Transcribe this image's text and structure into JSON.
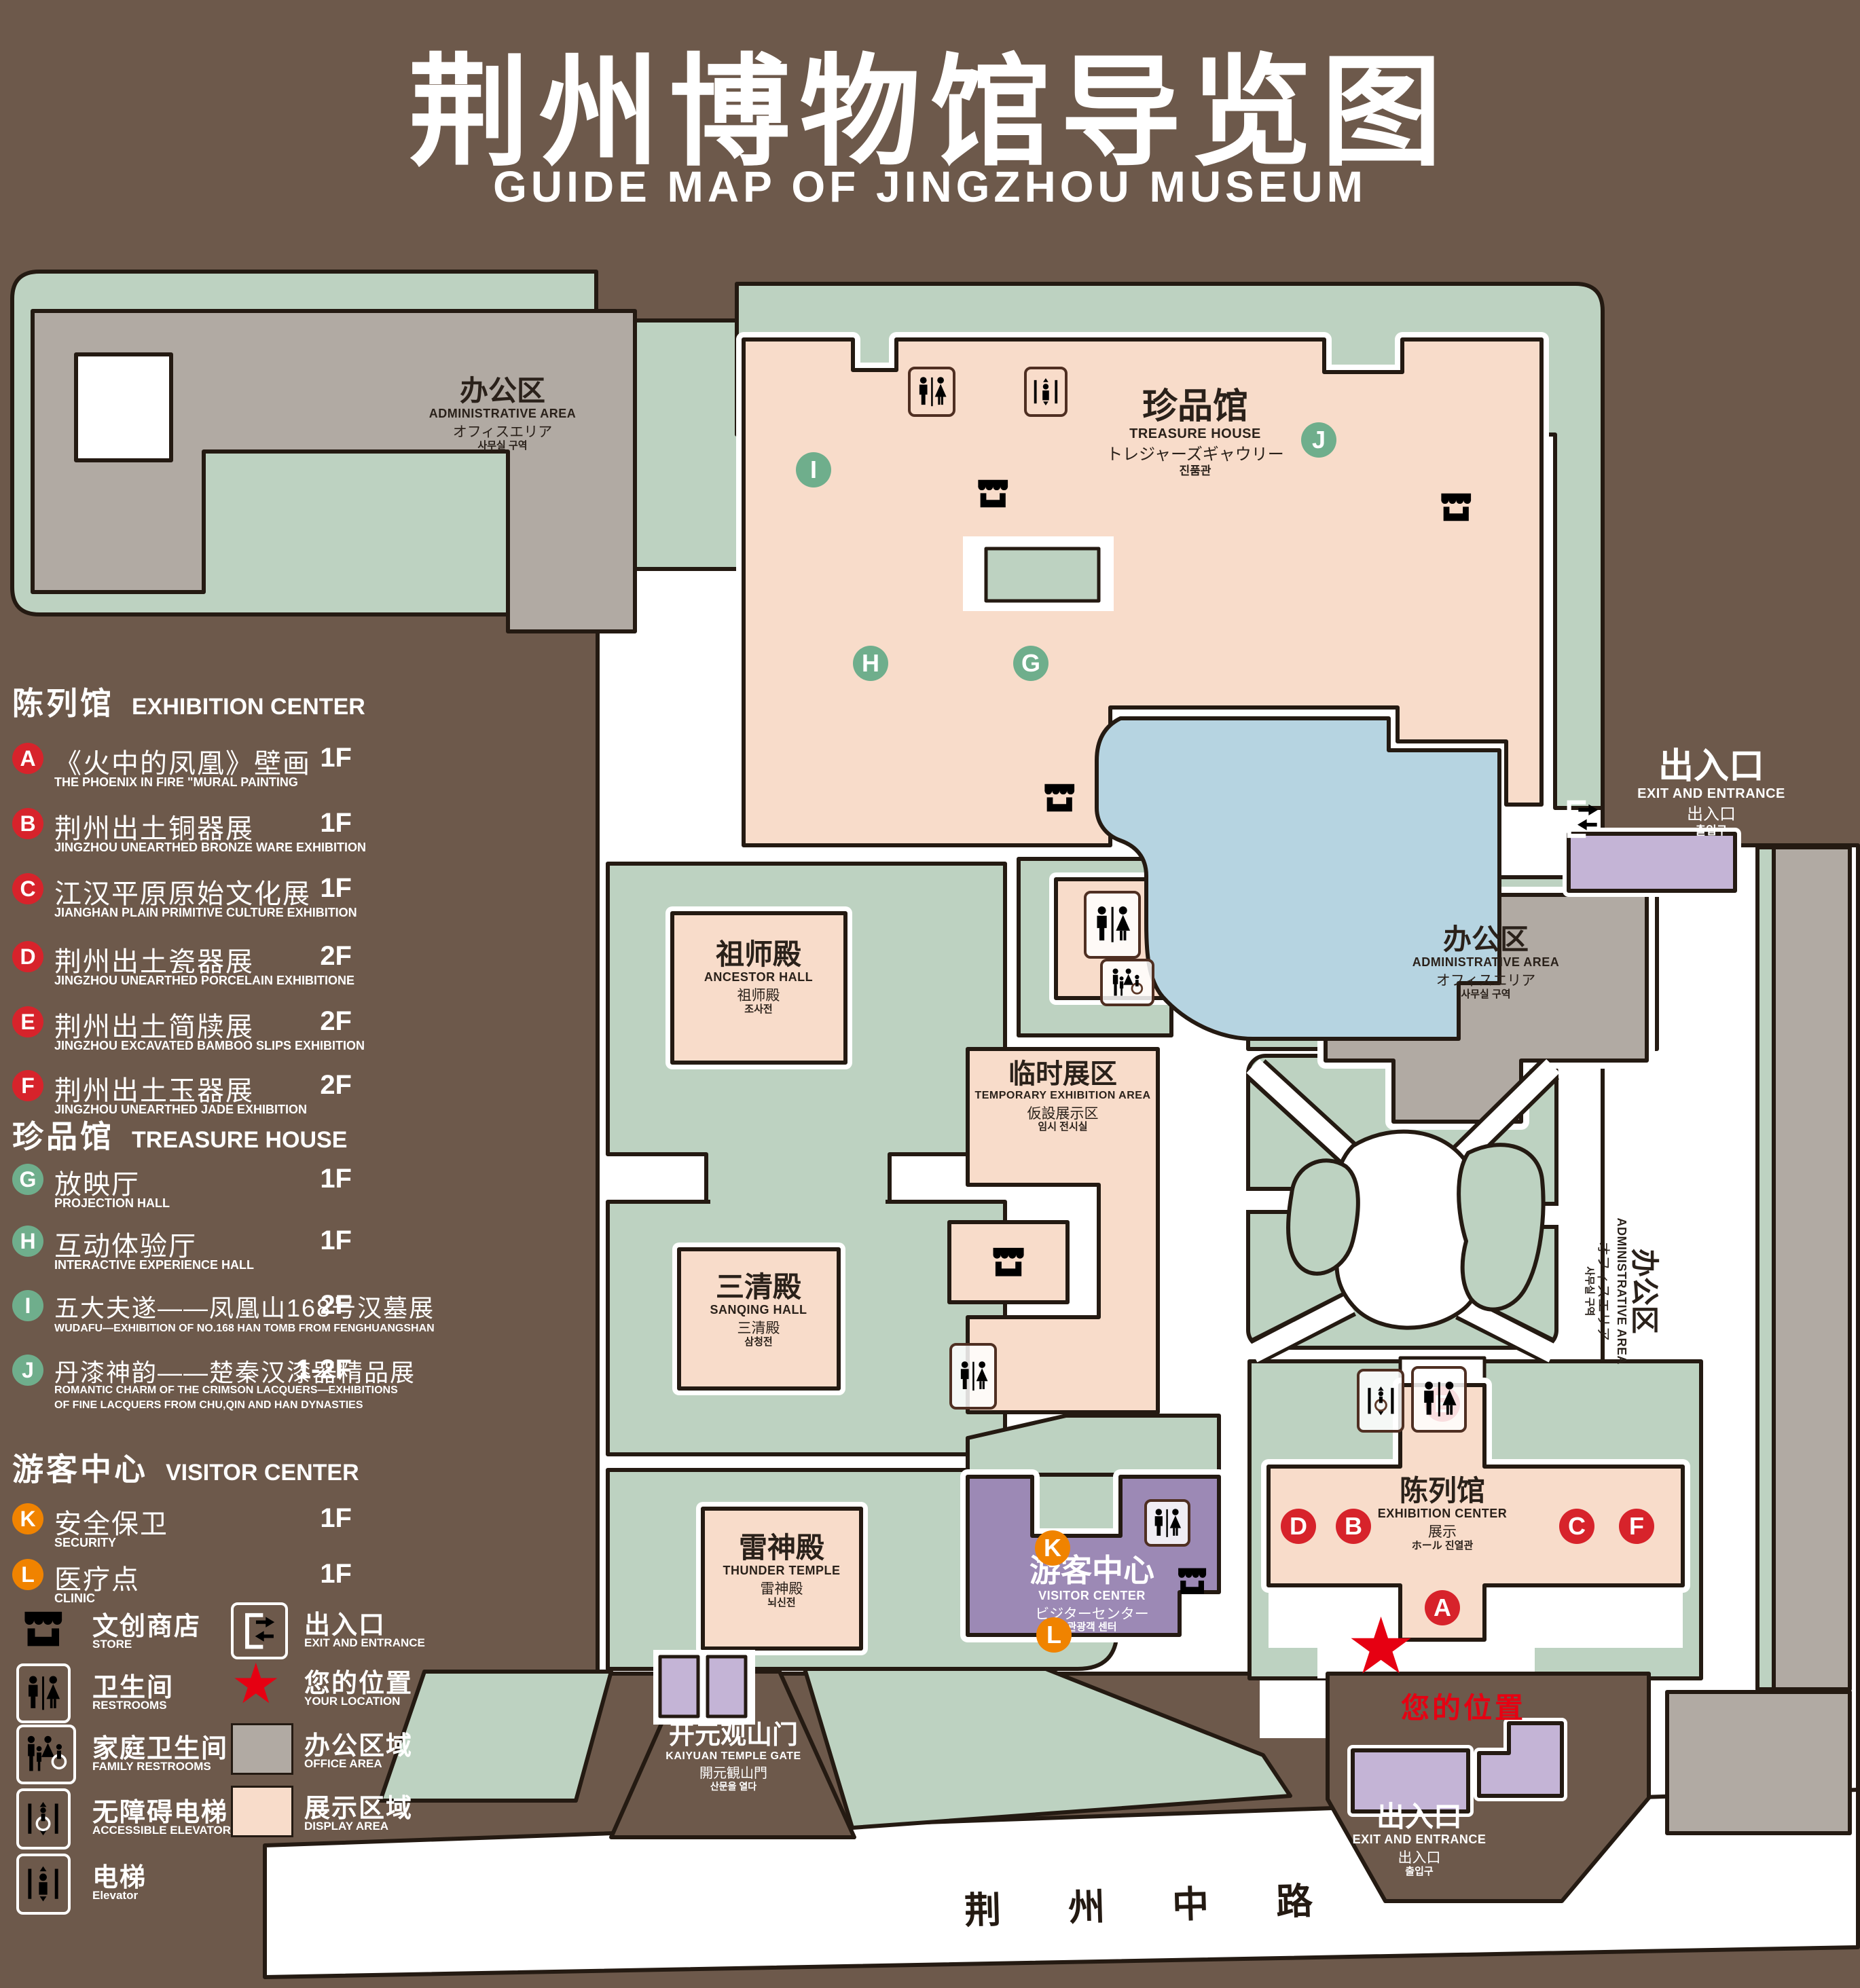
{
  "title": {
    "cn": "荆州博物馆导览图",
    "en": "GUIDE MAP OF JINGZHOU MUSEUM"
  },
  "legend": {
    "sections": [
      {
        "cn": "陈列馆",
        "en": "EXHIBITION CENTER",
        "items": [
          {
            "letter": "A",
            "cn": "《火中的凤凰》壁画",
            "en": "THE PHOENIX IN FIRE \"MURAL PAINTING",
            "floor": "1F"
          },
          {
            "letter": "B",
            "cn": "荆州出土铜器展",
            "en": "JINGZHOU UNEARTHED BRONZE WARE EXHIBITION",
            "floor": "1F"
          },
          {
            "letter": "C",
            "cn": "江汉平原原始文化展",
            "en": "JIANGHAN PLAIN PRIMITIVE CULTURE EXHIBITION",
            "floor": "1F"
          },
          {
            "letter": "D",
            "cn": "荆州出土瓷器展",
            "en": "JINGZHOU UNEARTHED PORCELAIN EXHIBITIONE",
            "floor": "2F"
          },
          {
            "letter": "E",
            "cn": "荆州出土简牍展",
            "en": "JINGZHOU EXCAVATED BAMBOO SLIPS EXHIBITION",
            "floor": "2F"
          },
          {
            "letter": "F",
            "cn": "荆州出土玉器展",
            "en": "JINGZHOU UNEARTHED JADE EXHIBITION",
            "floor": "2F"
          }
        ]
      },
      {
        "cn": "珍品馆",
        "en": "TREASURE HOUSE",
        "items": [
          {
            "letter": "G",
            "cn": "放映厅",
            "en": "PROJECTION HALL",
            "floor": "1F"
          },
          {
            "letter": "H",
            "cn": "互动体验厅",
            "en": "INTERACTIVE EXPERIENCE HALL",
            "floor": "1F"
          },
          {
            "letter": "I",
            "cn": "五大夫遂——凤凰山168号汉墓展",
            "en": "WUDAFU—EXHIBITION OF NO.168 HAN TOMB FROM FENGHUANGSHAN",
            "floor": "2F"
          },
          {
            "letter": "J",
            "cn": "丹漆神韵——楚秦汉漆器精品展",
            "en": "ROMANTIC CHARM OF THE CRIMSON LACQUERS—EXHIBITIONS",
            "en2": "OF FINE LACQUERS FROM CHU,QIN AND HAN DYNASTIES",
            "floor": "1-2F"
          }
        ]
      },
      {
        "cn": "游客中心",
        "en": "VISITOR CENTER",
        "items": [
          {
            "letter": "K",
            "cn": "安全保卫",
            "en": "SECURITY",
            "floor": "1F"
          },
          {
            "letter": "L",
            "cn": "医疗点",
            "en": "CLINIC",
            "floor": "1F"
          }
        ]
      }
    ],
    "symbols": {
      "store": {
        "cn": "文创商店",
        "en": "STORE"
      },
      "restrooms": {
        "cn": "卫生间",
        "en": "RESTROOMS"
      },
      "family": {
        "cn": "家庭卫生间",
        "en": "FAMILY RESTROOMS"
      },
      "accessible": {
        "cn": "无障碍电梯",
        "en": "ACCESSIBLE ELEVATOR"
      },
      "elevator": {
        "cn": "电梯",
        "en": "Elevator"
      },
      "exit": {
        "cn": "出入口",
        "en": "EXIT AND ENTRANCE"
      },
      "location": {
        "cn": "您的位置",
        "en": "YOUR LOCATION"
      },
      "office": {
        "cn": "办公区域",
        "en": "OFFICE AREA"
      },
      "display": {
        "cn": "展示区域",
        "en": "DISPLAY AREA"
      }
    }
  },
  "map": {
    "buildings": {
      "admin_nw": {
        "cn": "办公区",
        "en": "ADMINISTRATIVE AREA",
        "jp": "オフィスエリア",
        "kr": "사무실 구역"
      },
      "treasure": {
        "cn": "珍品馆",
        "en": "TREASURE HOUSE",
        "jp": "トレジャーズギャウリー",
        "kr": "진품관"
      },
      "ancestor": {
        "cn": "祖师殿",
        "en": "ANCESTOR HALL",
        "jp": "祖师殿",
        "kr": "조사전"
      },
      "sanqing": {
        "cn": "三清殿",
        "en": "SANQING HALL",
        "jp": "三清殿",
        "kr": "삼청전"
      },
      "thunder": {
        "cn": "雷神殿",
        "en": "THUNDER TEMPLE",
        "jp": "雷神殿",
        "kr": "뇌신전"
      },
      "temporary": {
        "cn": "临时展区",
        "en": "TEMPORARY EXHIBITION AREA",
        "jp": "仮設展示区",
        "kr": "임시 전시실"
      },
      "admin_c": {
        "cn": "办公区",
        "en": "ADMINISTRATIVE AREA",
        "jp": "オフィスエリア",
        "kr": "사무실 구역"
      },
      "admin_e": {
        "cn": "办公区",
        "en": "ADMINISTRATIVE AREA",
        "jp": "オフィスエリア",
        "kr": "사무실 구역"
      },
      "exhibition": {
        "cn": "陈列馆",
        "en": "EXHIBITION CENTER",
        "jp": "展示",
        "kr": "ホール 진열관"
      },
      "visitor": {
        "cn": "游客中心",
        "en": "VISITOR CENTER",
        "jp": "ビジターセンター",
        "kr": "관광객 센터"
      },
      "gate": {
        "cn": "开元观山门",
        "en": "KAIYUAN TEMPLE GATE",
        "jp": "開元観山門",
        "kr": "산문을 열다"
      },
      "exit_ne": {
        "cn": "出入口",
        "en": "EXIT AND ENTRANCE",
        "jp": "出入口",
        "kr": "출입구"
      },
      "exit_s": {
        "cn": "出入口",
        "en": "EXIT AND ENTRANCE",
        "jp": "出入口",
        "kr": "출입구"
      }
    },
    "road": "荆 州 中 路",
    "your_location": "您的位置",
    "star": "★",
    "markers": {
      "A": "A",
      "B": "B",
      "C": "C",
      "D": "D",
      "E": "E",
      "F": "F",
      "G": "G",
      "H": "H",
      "I": "I",
      "J": "J",
      "K": "K",
      "L": "L"
    },
    "colors": {
      "background": "#6d594b",
      "lawn": "#bdd2c1",
      "display_area": "#f8dcca",
      "office_area": "#b1aaa3",
      "water": "#b6d4e1",
      "purple": "#c4b4d6",
      "marker_red": "#d7232b",
      "marker_green": "#6fae8c",
      "marker_orange": "#f08300",
      "location_red": "#e60012"
    }
  }
}
